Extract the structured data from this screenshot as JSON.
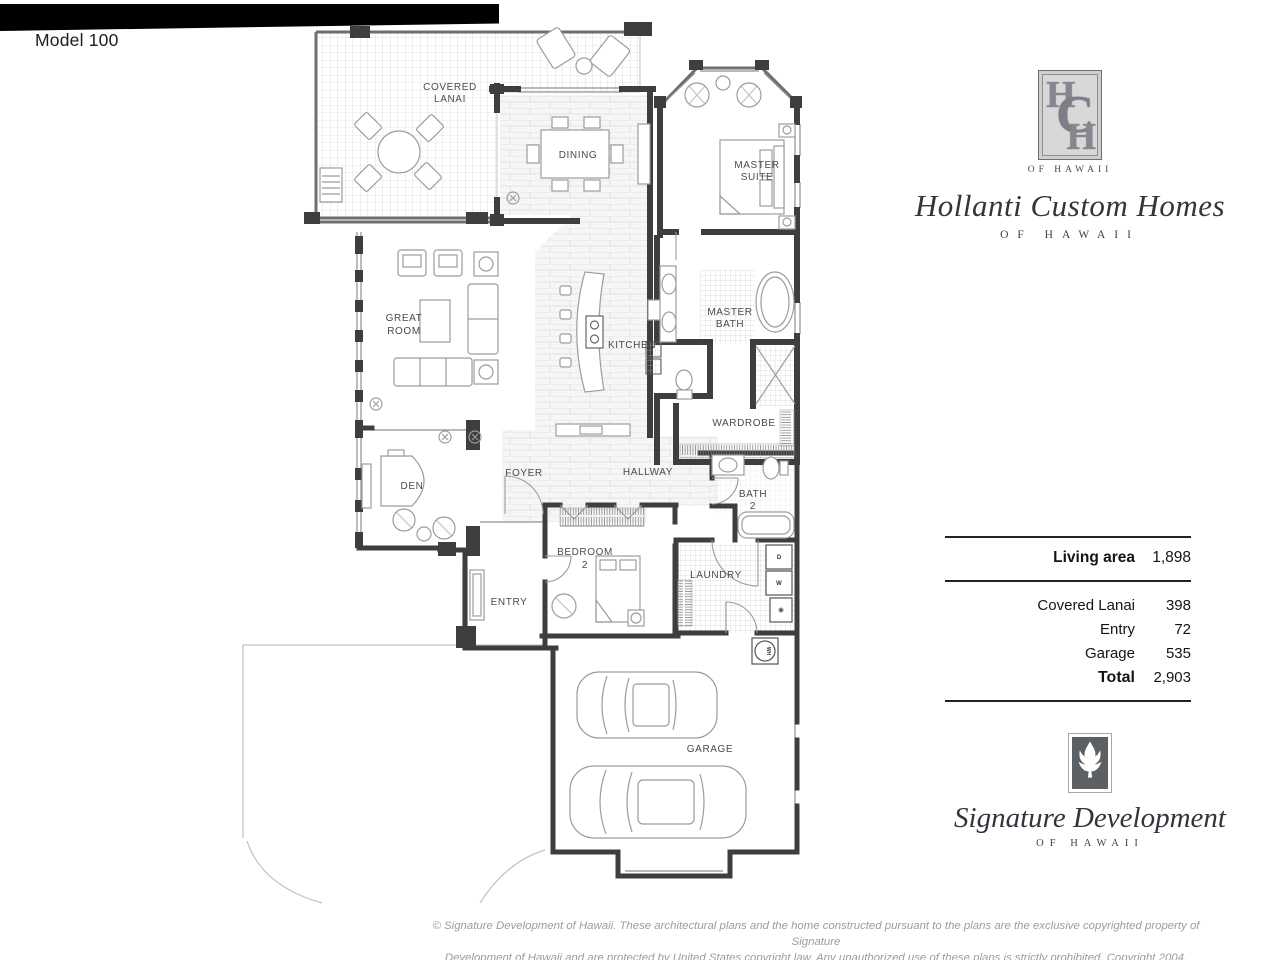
{
  "header": {
    "model": "Model 100"
  },
  "rooms": {
    "covered_lanai_1": "COVERED",
    "covered_lanai_2": "LANAI",
    "dining": "DINING",
    "master_suite_1": "MASTER",
    "master_suite_2": "SUITE",
    "great_room_1": "GREAT",
    "great_room_2": "ROOM",
    "kitchen": "KITCHEN",
    "master_bath_1": "MASTER",
    "master_bath_2": "BATH",
    "wardrobe": "WARDROBE",
    "den": "DEN",
    "foyer": "FOYER",
    "hallway": "HALLWAY",
    "bath2_1": "BATH",
    "bath2_2": "2",
    "bedroom2_1": "BEDROOM",
    "bedroom2_2": "2",
    "laundry": "LAUNDRY",
    "entry": "ENTRY",
    "garage": "GARAGE"
  },
  "appliances": {
    "water_heater": "WH",
    "washer": "W",
    "dryer": "D"
  },
  "builder": {
    "monogram_h1": "H",
    "monogram_c": "C",
    "monogram_h2": "H",
    "monogram_caption": "OF HAWAII",
    "name": "Hollanti Custom Homes",
    "subtitle": "OF HAWAII"
  },
  "area_table": {
    "living_label": "Living area",
    "living_value": "1,898",
    "rows": [
      {
        "label": "Covered Lanai",
        "value": "398"
      },
      {
        "label": "Entry",
        "value": "72"
      },
      {
        "label": "Garage",
        "value": "535"
      }
    ],
    "total_label": "Total",
    "total_value": "2,903"
  },
  "developer": {
    "name": "Signature Development",
    "subtitle": "OF HAWAII"
  },
  "footer": {
    "line1": "© Signature Development of Hawaii. These architectural plans and the home constructed pursuant to the plans are the exclusive copyrighted property of Signature",
    "line2": "Development  of Hawaii and are protected by United States copyright law. Any unauthorized use of these plans is strictly prohibited. Copyright 2004."
  },
  "colors": {
    "wall": "#3e3e3e",
    "monogram_gray": "#86868f",
    "signature_square": "#5b6064",
    "muted_text": "#9c9c9c"
  }
}
